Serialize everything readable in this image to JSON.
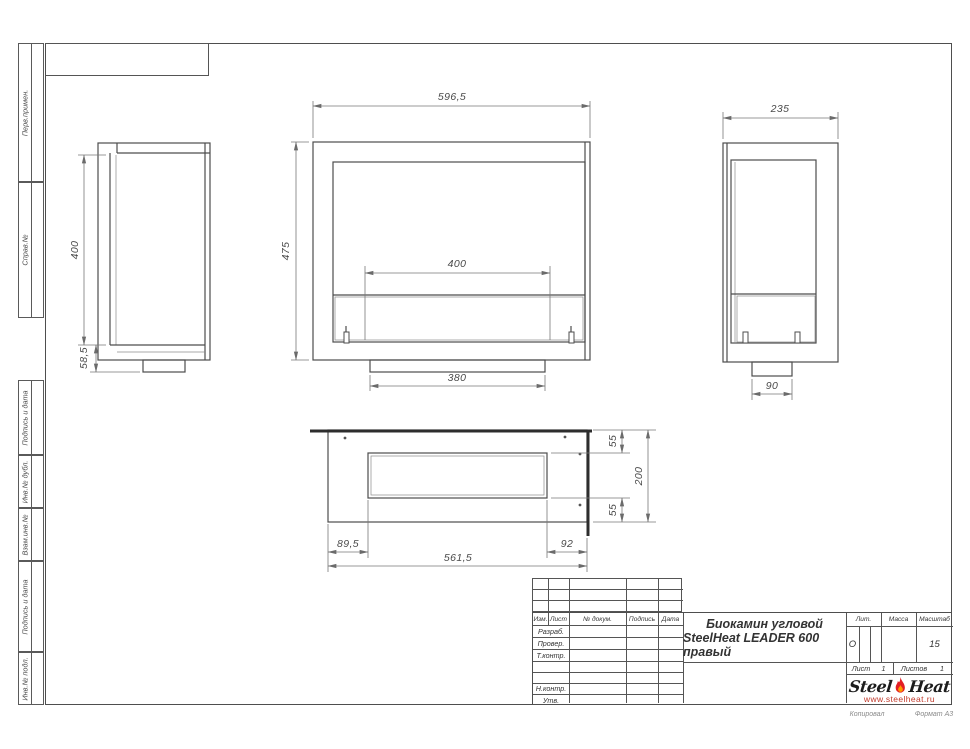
{
  "sheet": {
    "footer_left": "Копировал",
    "footer_right": "Формат А3"
  },
  "margin": {
    "boxes_top": [
      "Перв.примен.",
      "Справ.№"
    ],
    "boxes_bottom": [
      "Подпись и дата",
      "Инв.№ дубл.",
      "Взам.инв.№",
      "Подпись и дата",
      "Инв.№ подл."
    ]
  },
  "title_block": {
    "cols": {
      "izm": "Изм.",
      "list": "Лист",
      "doc": "№ докум.",
      "sign": "Подпись",
      "date": "Дата"
    },
    "roles": {
      "r1": "Разраб.",
      "r2": "Провер.",
      "r3": "Т.контр.",
      "r4": "Н.контр.",
      "r5": "Утв."
    },
    "title1": "Биокамин угловой",
    "title2": "SteelHeat LEADER 600 правый",
    "lit_label": "Лит.",
    "lit_value": "О",
    "mass_label": "Масса",
    "scale_label": "Масштаб",
    "scale_value": "15",
    "sheet_label": "Лист",
    "sheet_value": "1",
    "sheets_label": "Листов",
    "sheets_value": "1",
    "logo_word1": "Steel",
    "logo_word2": "Heat",
    "logo_url": "www.steelheat.ru"
  },
  "dims": {
    "side_left": {
      "glass_height": "400",
      "base_height": "58,5"
    },
    "front": {
      "width": "596,5",
      "height": "475",
      "burner": "400",
      "base": "380"
    },
    "side_right": {
      "depth": "235",
      "base": "90"
    },
    "plan": {
      "top": "55",
      "depth": "200",
      "bottom": "55",
      "left": "89,5",
      "width": "561,5",
      "right": "92"
    }
  },
  "colors": {
    "line": "#4a4a4a",
    "flame_red": "#e31e24",
    "flame_orange": "#ff9a00",
    "url_red": "#c0392b"
  }
}
